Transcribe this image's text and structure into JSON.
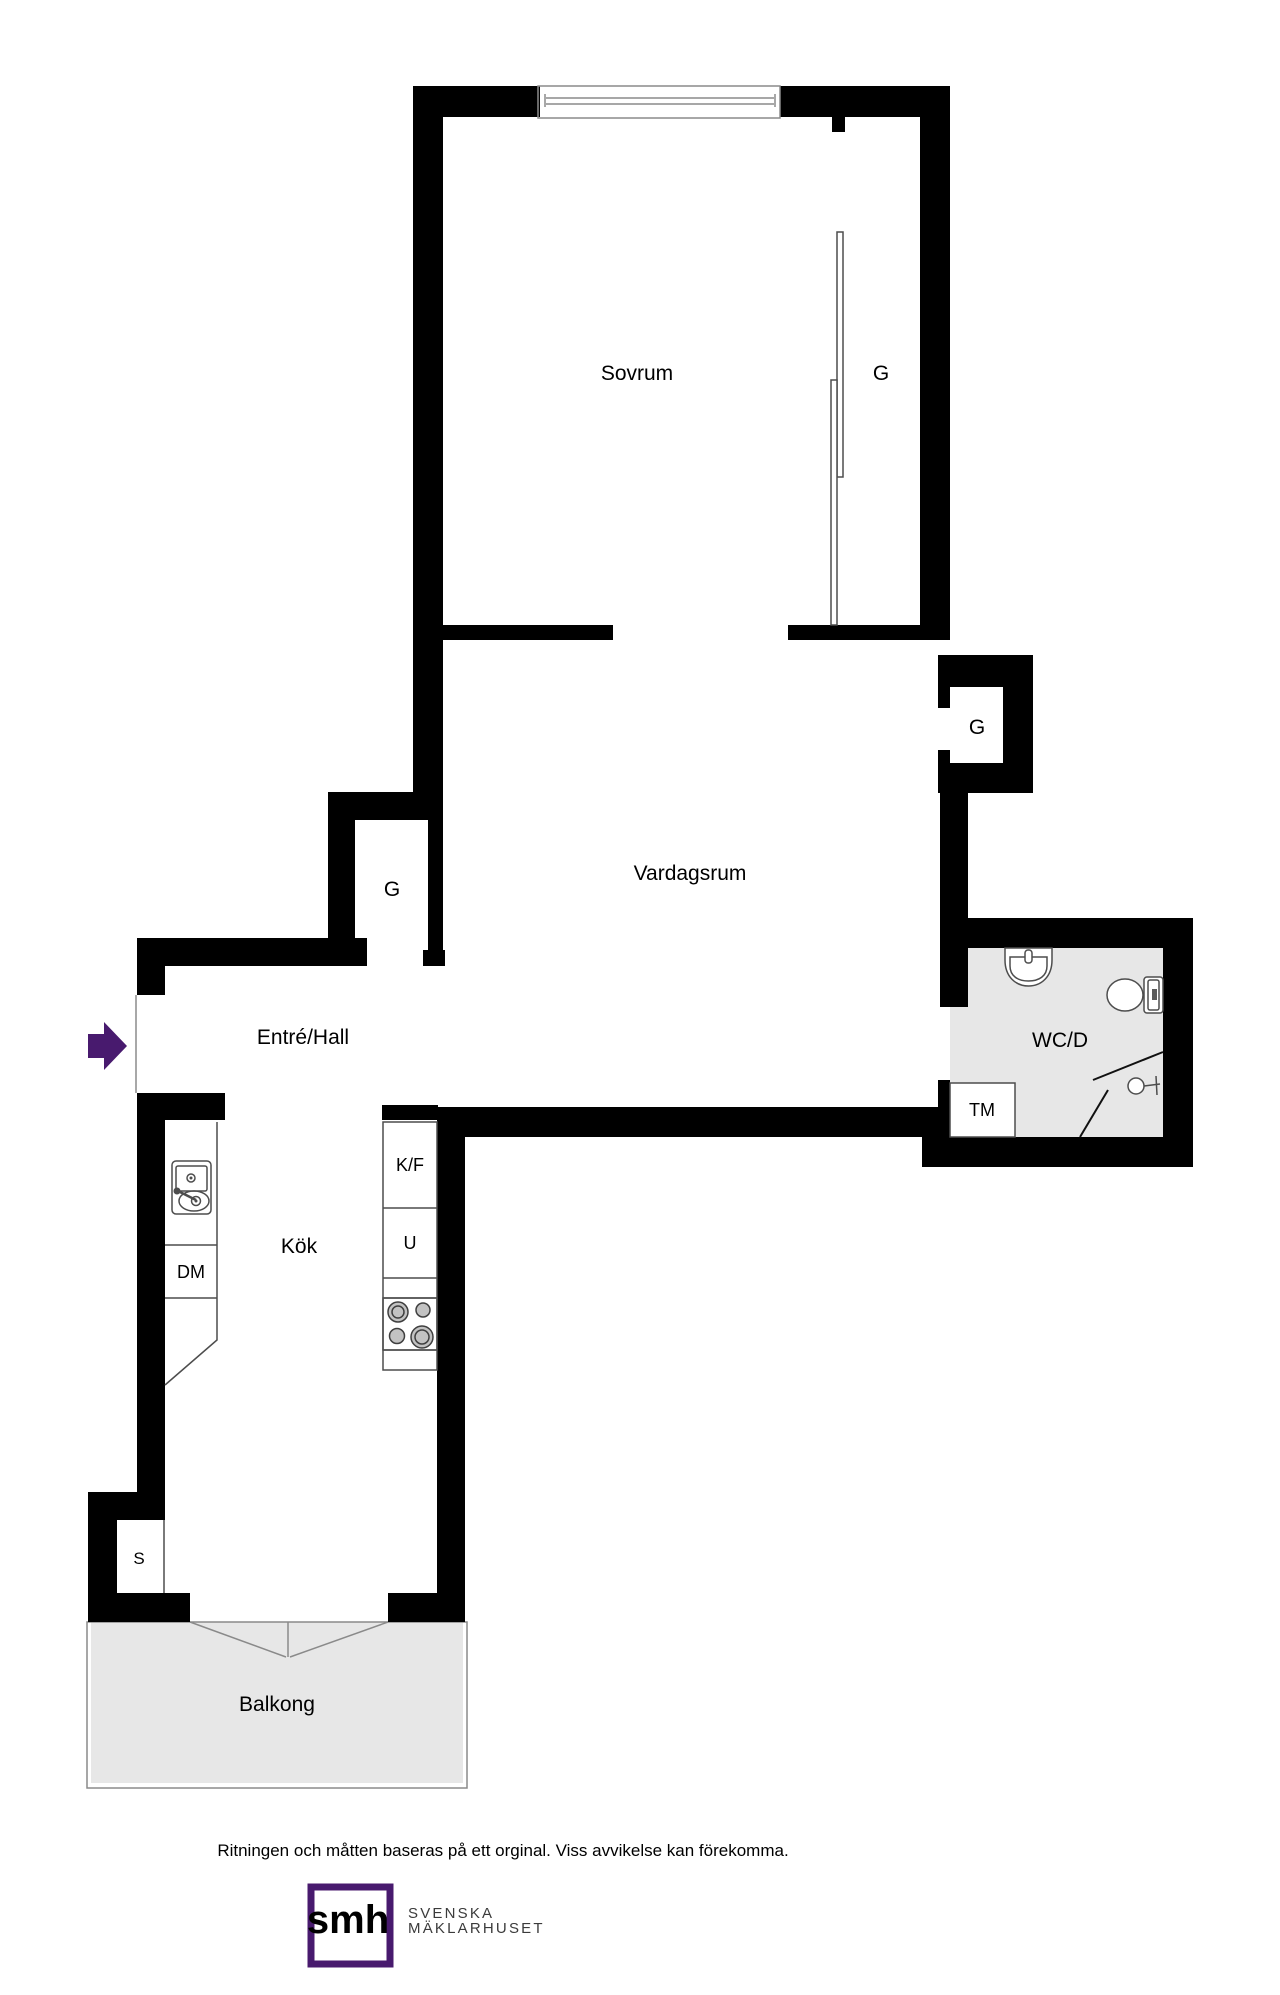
{
  "colors": {
    "wall": "#000000",
    "accent_purple": "#481a6e",
    "floor_gray": "#e7e7e7",
    "stove_gray": "#9d9d9d",
    "caption_gray": "#3b3b3b"
  },
  "rooms": {
    "bedroom": {
      "label": "Sovrum"
    },
    "living": {
      "label": "Vardagsrum"
    },
    "hall": {
      "label": "Entré/Hall"
    },
    "kitchen": {
      "label": "Kök"
    },
    "bath": {
      "label": "WC/D"
    },
    "balcony": {
      "label": "Balkong"
    }
  },
  "fixtures": {
    "wardrobe_bedroom": {
      "label": "G"
    },
    "wardrobe_living": {
      "label": "G"
    },
    "wardrobe_hall": {
      "label": "G"
    },
    "washing_machine": {
      "label": "TM"
    },
    "fridge_freezer": {
      "label": "K/F"
    },
    "oven": {
      "label": "U"
    },
    "dishwasher": {
      "label": "DM"
    },
    "cabinet": {
      "label": "S"
    }
  },
  "footer": {
    "disclaimer": "Ritningen och måtten baseras på ett orginal. Viss avvikelse kan förekomma."
  },
  "logo": {
    "monogram": "smh",
    "caption_line1": "SVENSKA",
    "caption_line2": "MÄKLARHUSET"
  }
}
